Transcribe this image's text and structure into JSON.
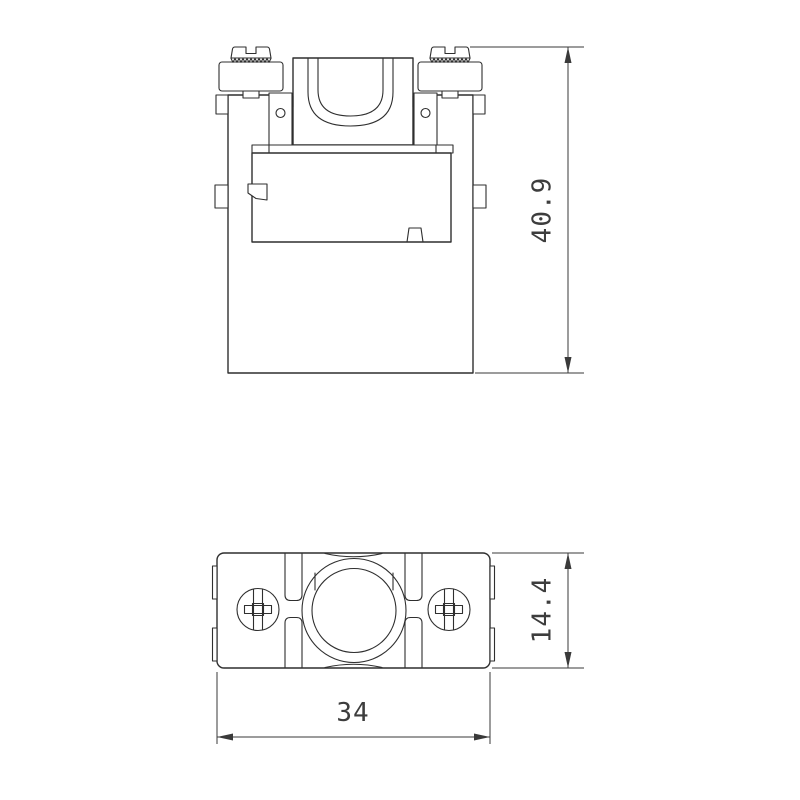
{
  "drawing": {
    "background": "#ffffff",
    "line_color": "#2f2f2f",
    "text_color": "#3d3d3d",
    "views": {
      "front_view": {
        "dimension_height": {
          "value": "40.9",
          "orientation": "vertical"
        }
      },
      "top_view": {
        "dimension_height": {
          "value": "14.4",
          "orientation": "vertical"
        },
        "dimension_width": {
          "value": "34",
          "orientation": "horizontal"
        }
      }
    }
  }
}
